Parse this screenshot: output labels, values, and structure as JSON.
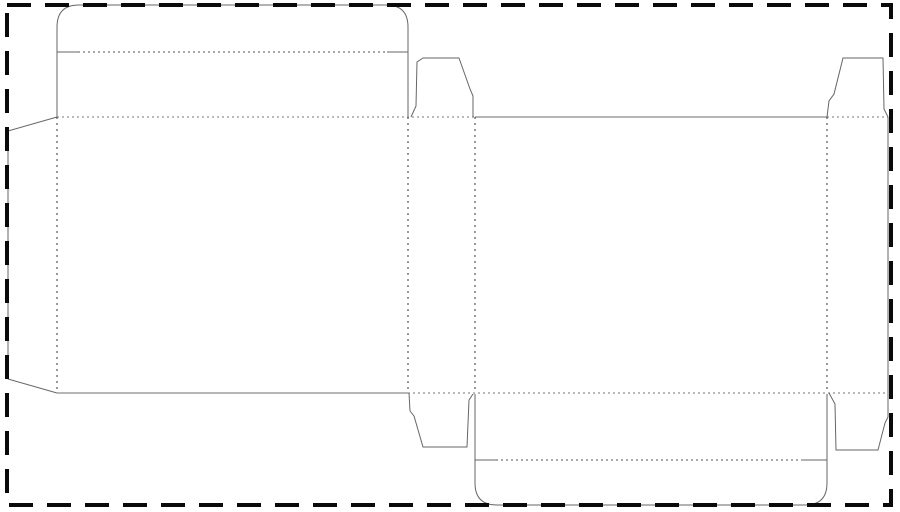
{
  "diagram": {
    "type": "packaging-dieline",
    "description": "Flat die-cut template (dieline) of a tuck-end folding carton laid out on a sheet bounded by a heavy dashed cut border. Solid lines are cuts, dotted lines are folds.",
    "canvas": {
      "width": 900,
      "height": 512,
      "background": "#ffffff"
    },
    "colors": {
      "sheet_border": "#0a0a0a",
      "cut_line": "#666666",
      "cut_line_light": "#b5b5b5",
      "fold_line_dark": "#555555",
      "fold_line_vertical": "#333333",
      "fold_line_light": "#a3a3a3"
    },
    "styles": {
      "border": {
        "color": "#0a0a0a",
        "width": 4,
        "dash": "24 14"
      },
      "cut": {
        "color": "#666666",
        "width": 1,
        "dash": ""
      },
      "cutLight": {
        "color": "#b5b5b5",
        "width": 2,
        "dash": ""
      },
      "foldDark": {
        "color": "#555555",
        "width": 1,
        "dash": "2 3"
      },
      "foldDot": {
        "color": "#333333",
        "width": 1,
        "dash": "2 4"
      },
      "foldLight": {
        "color": "#a3a3a3",
        "width": 1.5,
        "dash": "2 3"
      }
    },
    "parts": [
      "top-lid-with-rounded-tuck-flap",
      "glue-flap-left",
      "back-panel",
      "side-panel-left",
      "front-panel",
      "side-panel-right",
      "dust-flap-top-middle",
      "dust-flap-top-right",
      "dust-flap-bottom-middle",
      "dust-flap-bottom-right",
      "bottom-lid-with-rounded-tuck-flap",
      "sheet-cut-border"
    ],
    "elements": [
      {
        "name": "top-lid-outline",
        "style": "cut",
        "d": "M57 117 L57 27 Q57 5 79 5 L386 5 Q408 5 408 27 L408 117"
      },
      {
        "name": "top-lid-fold-notch-left",
        "style": "cut",
        "d": "M57 52 L78 52"
      },
      {
        "name": "top-lid-fold-line",
        "style": "foldDark",
        "d": "M78 52 L387 52"
      },
      {
        "name": "top-lid-fold-notch-right",
        "style": "cut",
        "d": "M387 52 L408 52"
      },
      {
        "name": "glue-flap-outline",
        "style": "cut",
        "d": "M57 117 L8 131 L8 379 L57 393"
      },
      {
        "name": "fold-back-panel-top",
        "style": "foldLight",
        "d": "M57 117 L475 117"
      },
      {
        "name": "edge-front-panel-top",
        "style": "cutLight",
        "d": "M475 117 L827 117"
      },
      {
        "name": "fold-right-panel-top",
        "style": "foldLight",
        "d": "M827 117 L888 117"
      },
      {
        "name": "edge-back-panel-bottom",
        "style": "cutLight",
        "d": "M57 393 L408 393"
      },
      {
        "name": "fold-bottom-row",
        "style": "foldLight",
        "d": "M408 393 L888 393"
      },
      {
        "name": "vertical-fold-glue-flap",
        "style": "foldDot",
        "d": "M57 117 L57 393"
      },
      {
        "name": "vertical-fold-back-side",
        "style": "foldDot",
        "d": "M408 117 L408 393"
      },
      {
        "name": "vertical-fold-side-front",
        "style": "foldDot",
        "d": "M475 117 L475 393"
      },
      {
        "name": "vertical-fold-front-side",
        "style": "foldDot",
        "d": "M827 117 L827 393"
      },
      {
        "name": "edge-right-panel",
        "style": "cut",
        "d": "M888 117 L888 393"
      },
      {
        "name": "dust-flap-top-middle",
        "style": "cut",
        "d": "M411 117 L416 106 L417 62 L423 58 L459 58 L470 89 L473 96 L473 117"
      },
      {
        "name": "dust-flap-top-right",
        "style": "cut",
        "d": "M827 117 L829 101 L834 94 L843 58 L883 58 L884 109 L888 117"
      },
      {
        "name": "dust-flap-bottom-middle",
        "style": "cut",
        "d": "M409 393 L410 411 L414 416 L423 447 L467 447 L469 400 L473 394"
      },
      {
        "name": "dust-flap-bottom-right",
        "style": "cut",
        "d": "M829 393 L835 404 L836 450 L878 450 L885 423 L888 417 L888 393"
      },
      {
        "name": "bottom-lid-outline",
        "style": "cut",
        "d": "M475 394 L475 483 Q475 505 497 505 L805 505 Q827 505 827 483 L827 394"
      },
      {
        "name": "bottom-lid-fold-notch-left",
        "style": "cut",
        "d": "M475 460 L496 460"
      },
      {
        "name": "bottom-lid-fold-line",
        "style": "foldDark",
        "d": "M496 460 L801 460"
      },
      {
        "name": "bottom-lid-fold-notch-right",
        "style": "cut",
        "d": "M801 460 L827 460"
      },
      {
        "name": "sheet-cut-border",
        "style": "border",
        "d": "M7 5 L891 5 L891 505 L7 505 Z"
      }
    ]
  }
}
